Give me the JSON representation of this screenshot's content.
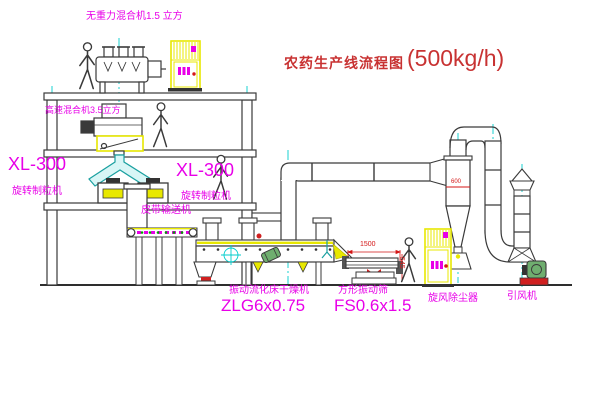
{
  "title": {
    "cn": "农药生产线流程图",
    "capacity": "(500kg/h)"
  },
  "labels": {
    "top_mixer": "无重力混合机1.5 立方",
    "speed_mixer": "高速混合机3.5立方",
    "xl300_left": "XL-300",
    "granulator_left": "旋转制粒机",
    "xl300_mid": "XL-300",
    "granulator_mid": "旋转制粒机",
    "belt_conveyor": "皮带输送机",
    "dryer_name": "振动流化床干燥机",
    "dryer_model": "ZLG6x0.75",
    "sieve_name": "方形振动筛",
    "sieve_model": "FS0.6x1.5",
    "cyclone": "旋风除尘器",
    "fan": "引风机"
  },
  "dimensions": {
    "sieve_length": "1500",
    "sieve_height": "545",
    "cyclone_diameter": "600"
  },
  "colors": {
    "line": "#3a3a3a",
    "centerline": "#00cdcd",
    "highlight": "#e8e800",
    "label": "#e800e8",
    "title": "#c83232",
    "dimension": "#d41616",
    "belt_dots": "#00a000"
  }
}
